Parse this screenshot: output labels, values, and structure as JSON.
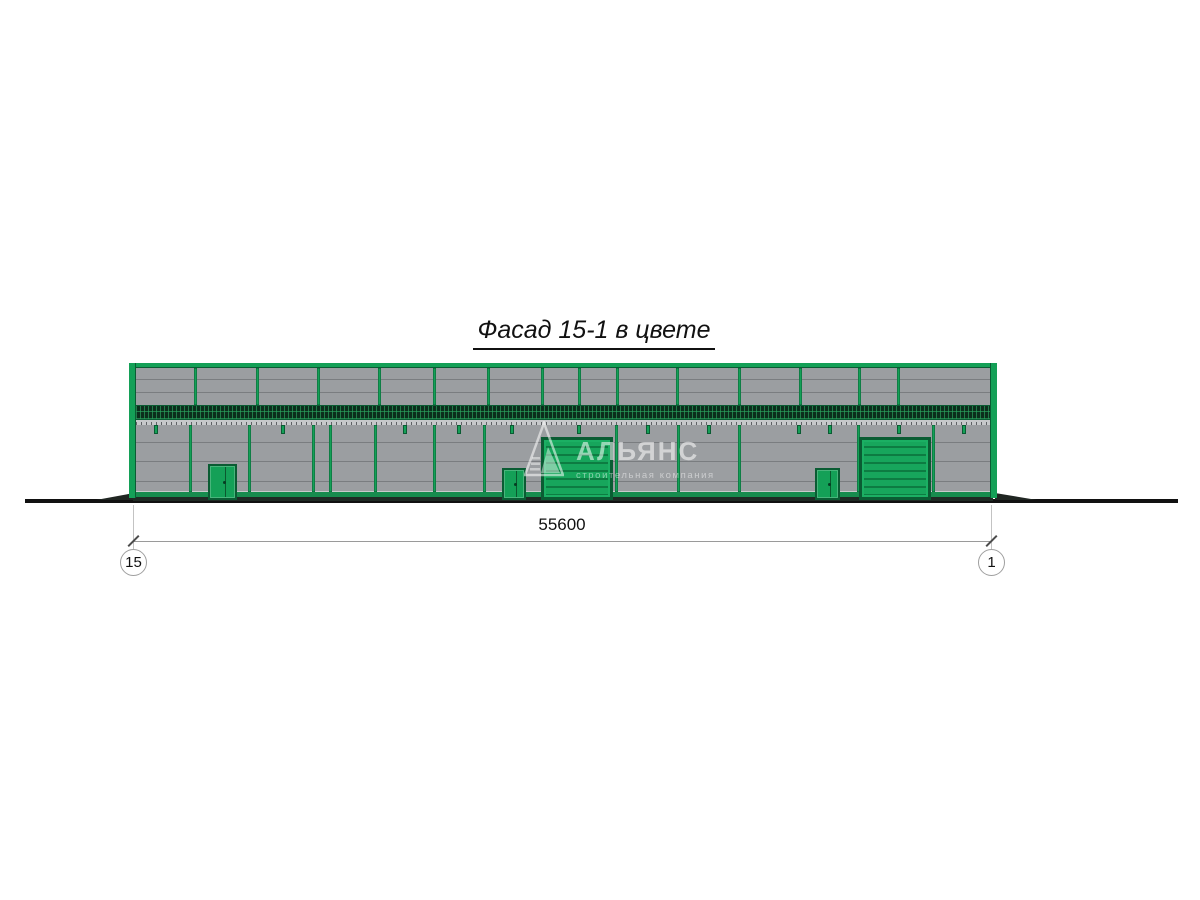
{
  "title": "Фасад 15-1 в цвете",
  "watermark": {
    "name": "АЛЬЯНС",
    "tagline": "строительная компания"
  },
  "dimension": {
    "value": "55600",
    "axis_left": "15",
    "axis_right": "1"
  },
  "colors": {
    "frame_green": "#14A057",
    "frame_dark": "#0A5C33",
    "panel_gray": "#9B9EA1",
    "panel_line": "#7A7D80",
    "band_dark": "#0B2E1C",
    "band_grid": "#1F9155",
    "sill_gray": "#C6C8CA",
    "plinth_green": "#178C4E",
    "ground_black": "#111111",
    "dim_line": "#9A9A9A",
    "text_black": "#111111"
  },
  "building": {
    "top_mullions_px": [
      65,
      127,
      188,
      249,
      304,
      358,
      412,
      449,
      487,
      547,
      609,
      670,
      729,
      768
    ],
    "bottom_mullions_px": [
      60,
      119,
      183,
      200,
      245,
      304,
      354,
      486,
      548,
      609,
      728,
      803
    ],
    "stub_px": [
      25,
      152,
      274,
      328,
      381,
      448,
      517,
      578,
      668,
      699,
      768,
      833
    ],
    "doors": [
      {
        "kind": "door",
        "name": "door-left",
        "x": 79,
        "y": 101,
        "w": 29,
        "h": 36
      },
      {
        "kind": "door",
        "name": "door-center",
        "x": 373,
        "y": 105,
        "w": 24,
        "h": 32
      },
      {
        "kind": "garage",
        "name": "garage-door-center",
        "x": 412,
        "y": 74,
        "w": 72,
        "h": 63
      },
      {
        "kind": "door",
        "name": "door-right",
        "x": 686,
        "y": 105,
        "w": 25,
        "h": 32
      },
      {
        "kind": "garage",
        "name": "garage-door-right",
        "x": 730,
        "y": 74,
        "w": 72,
        "h": 63
      }
    ]
  }
}
